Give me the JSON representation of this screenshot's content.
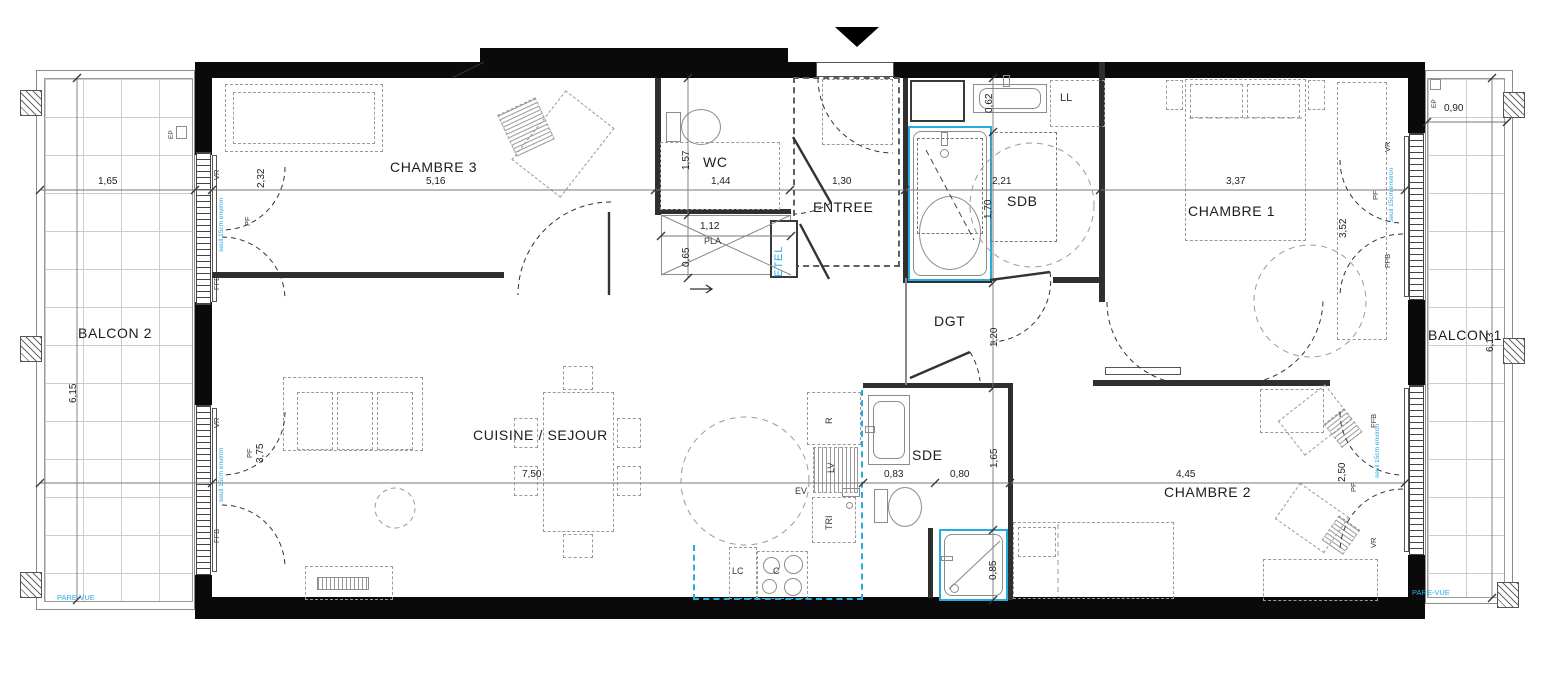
{
  "plan": {
    "rooms": {
      "chambre3": "CHAMBRE 3",
      "wc": "WC",
      "entree": "ENTREE",
      "sdb": "SDB",
      "chambre1": "CHAMBRE 1",
      "chambre2": "CHAMBRE 2",
      "sde": "SDE",
      "dgt": "DGT",
      "cuisine_sejour": "CUISINE / SEJOUR",
      "balcon1": "BALCON 1",
      "balcon2": "BALCON 2"
    },
    "dims": {
      "balcon2_w": "1,65",
      "chambre3_w": "5,16",
      "wc_w": "1,44",
      "entree_w": "1,30",
      "sdb_w": "2,21",
      "chambre1_w": "3,37",
      "balcon1_w": "0,90",
      "chambre3_d": "2,32",
      "wc_d": "1,57",
      "pla_w": "1,12",
      "pla_d": "0,65",
      "sdb_basin": "0,62",
      "sdb_bath": "1,70",
      "dgt_d": "1,20",
      "sejour_w": "7,50",
      "sde_w1": "0,83",
      "sde_w2": "0,80",
      "sde_d": "1,65",
      "shower_w": "0,85",
      "chambre2_w": "4,45",
      "chambre1_d": "3,52",
      "chambre2_d": "2,50",
      "sejour_d": "3,75",
      "balcon2_d": "6,15",
      "balcon1_d": "6,13"
    },
    "ann": {
      "pla": "PLA",
      "etel": "ETEL",
      "ll": "LL",
      "r": "R",
      "lv": "LV",
      "ev": "EV",
      "tri": "TRI",
      "lc": "LC",
      "c": "C",
      "pare_vue": "PARE-VUE",
      "ep": "EP",
      "vr": "VR",
      "pf": "PF",
      "ffb": "FFB",
      "seuil": "seuil 15cm environ"
    },
    "colors": {
      "accent_blue": "#29abe2",
      "wall_black": "#0a0a0a",
      "furniture_gray": "#9a9a9a"
    }
  }
}
